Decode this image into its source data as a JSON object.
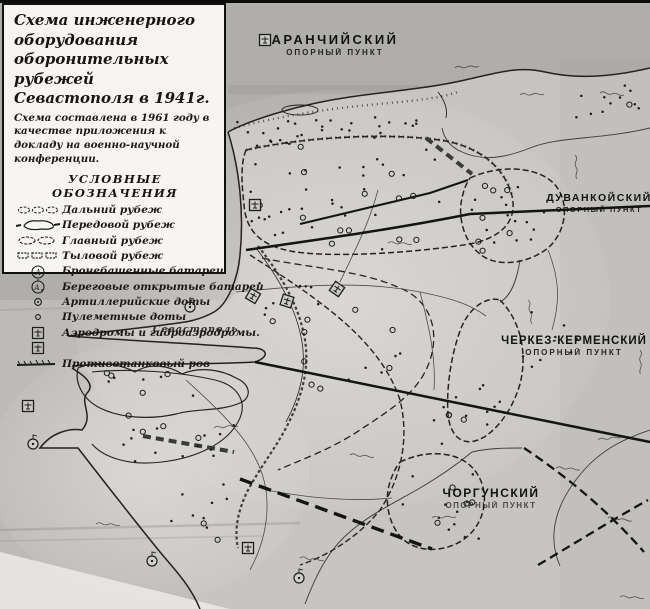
{
  "legend": {
    "title": "Схема инженерного оборудования оборонительных рубежей Севастополя в 1941г.",
    "subtitle": "Схема составлена в 1961 году в качестве приложения к докладу на военно-научной конференции.",
    "section_header": "УСЛОВНЫЕ ОБОЗНАЧЕНИЯ",
    "items": [
      {
        "symbol": "far-line-icon",
        "label": "Дальний рубеж"
      },
      {
        "symbol": "forward-line-icon",
        "label": "Передовой рубеж"
      },
      {
        "symbol": "main-line-icon",
        "label": "Главный рубеж"
      },
      {
        "symbol": "rear-line-icon",
        "label": "Тыловой рубеж"
      },
      {
        "symbol": "armored-turret-battery-icon",
        "label": "Бронебашенные батареи",
        "glyph": "А"
      },
      {
        "symbol": "coastal-open-battery-icon",
        "label": "Береговые открытые батареи",
        "glyph": "А"
      },
      {
        "symbol": "artillery-pillbox-icon",
        "label": "Артиллерийские доты"
      },
      {
        "symbol": "mg-pillbox-icon",
        "label": "Пулеметные доты"
      },
      {
        "symbol": "airfield-icon",
        "label": "Аэродромы и гидроаэродромы."
      },
      {
        "symbol": "antitank-ditch-icon",
        "label": "Противотанковый ров"
      }
    ]
  },
  "map": {
    "strongpoints": [
      {
        "name": "АРАНЧИЙСКИЙ",
        "sub": "ОПОРНЫЙ ПУНКТ"
      },
      {
        "name": "ДУВАНКОЙСКИЙ",
        "sub": "ОПОРНЫЙ ПУНКТ"
      },
      {
        "name": "ЧЕРКЕЗ-КЕРМЕНСКИЙ",
        "sub": "ОПОРНЫЙ ПУНКТ"
      },
      {
        "name": "ЧОРГУНСКИЙ",
        "sub": "ОПОРНЫЙ ПУНКТ"
      }
    ],
    "places": [
      {
        "name": "Севастополь"
      }
    ]
  },
  "colors": {
    "paper": "#c6c4c0",
    "sea": "#aeaca9",
    "ink": "#1d1d1d",
    "legend_bg": "#f6f5f2"
  }
}
